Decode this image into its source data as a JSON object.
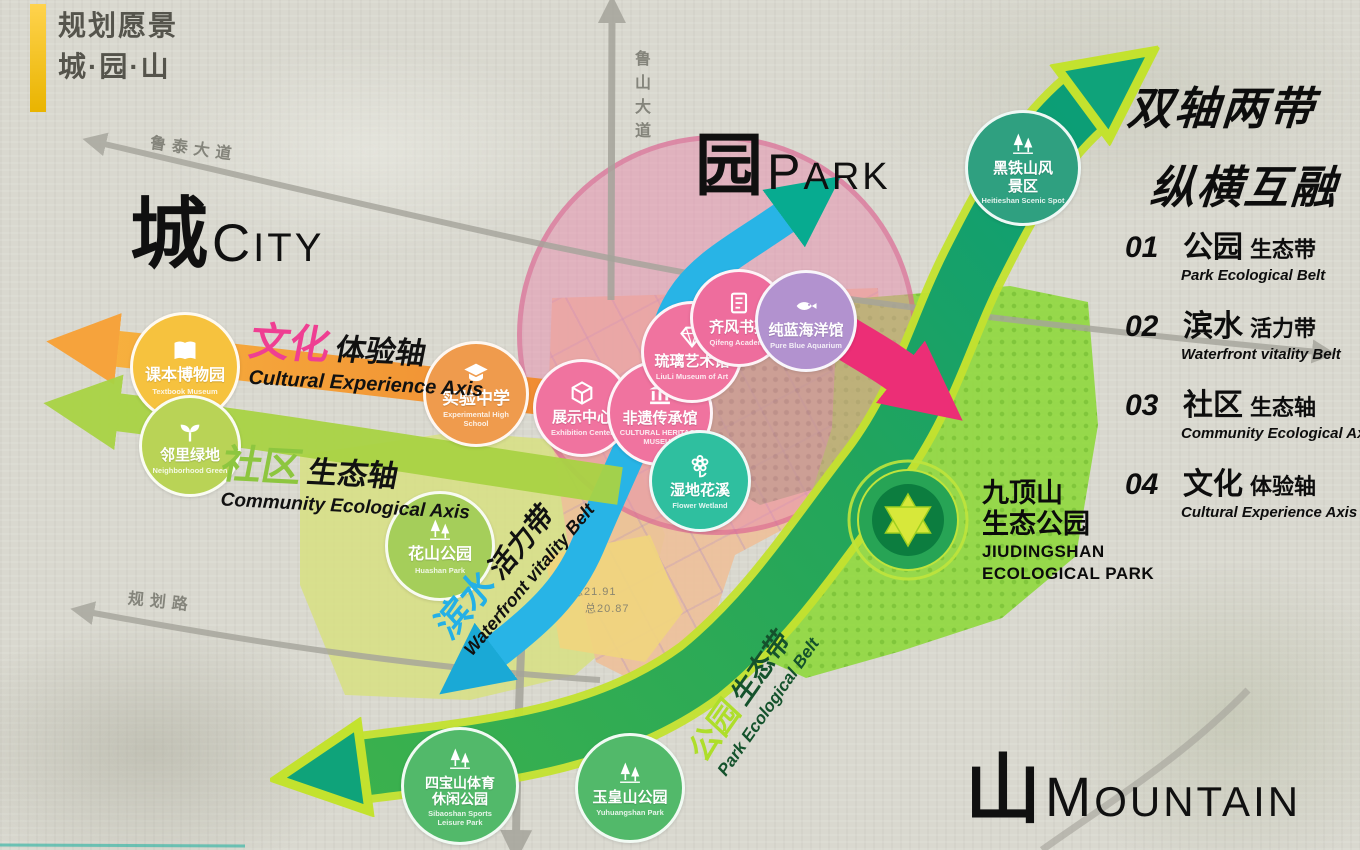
{
  "logo": {
    "line1": "规划愿景",
    "line2": "城·园·山"
  },
  "headline": {
    "line1": "双轴两带",
    "line2": "纵横互融"
  },
  "legend": [
    {
      "num": "01",
      "cn_main": "公园",
      "cn_sub": "生态带",
      "en": "Park Ecological Belt"
    },
    {
      "num": "02",
      "cn_main": "滨水",
      "cn_sub": "活力带",
      "en": "Waterfront vitality Belt"
    },
    {
      "num": "03",
      "cn_main": "社区",
      "cn_sub": "生态轴",
      "en": "Community Ecological Axis"
    },
    {
      "num": "04",
      "cn_main": "文化",
      "cn_sub": "体验轴",
      "en": "Cultural Experience Axis"
    }
  ],
  "zone_labels": {
    "city_cn": "城",
    "city_en": "CITY",
    "park_cn": "园",
    "park_en": "PARK",
    "mountain_cn": "山",
    "mountain_en": "MOUNTAIN"
  },
  "axis_labels": {
    "cultural": {
      "cn_main": "文化",
      "cn_sub": "体验轴",
      "en": "Cultural Experience Axis"
    },
    "community": {
      "cn_main": "社区",
      "cn_sub": "生态轴",
      "en": "Community Ecological Axis"
    },
    "waterfront": {
      "cn_main": "滨水",
      "cn_sub": "活力带",
      "en": "Waterfront vitality Belt"
    },
    "park_belt": {
      "cn_main": "公园",
      "cn_sub": "生态带",
      "en": "Park Ecological Belt"
    }
  },
  "roads": {
    "lutai": "鲁泰大道",
    "lushan": "鲁山大道",
    "guihua": "规划路"
  },
  "badges": [
    {
      "id": "textbook-museum",
      "cn": "课本博物园",
      "en": "Textbook Museum",
      "icon": "open-book-icon",
      "color": "#f6c23e"
    },
    {
      "id": "neighborhood-green",
      "cn": "邻里绿地",
      "en": "Neighborhood Green",
      "icon": "sprout-icon",
      "color": "#b9d356"
    },
    {
      "id": "experimental-school",
      "cn": "实验中学",
      "en": "Experimental High School",
      "icon": "graduation-cap-icon",
      "color": "#ef9b4d"
    },
    {
      "id": "exhibition-center",
      "cn": "展示中心",
      "en": "Exhibition Center",
      "icon": "cube-icon",
      "color": "#f0739f"
    },
    {
      "id": "heritage-museum",
      "cn": "非遗传承馆",
      "en": "CULTURAL HERITAGE MUSEUM",
      "icon": "museum-icon",
      "color": "#f0739f"
    },
    {
      "id": "liuli-art-museum",
      "cn": "琉璃艺术馆",
      "en": "LiuLi Museum of Art",
      "icon": "diamond-icon",
      "color": "#f0739f"
    },
    {
      "id": "qifeng-academy",
      "cn": "齐风书苑",
      "en": "Qifeng Academy",
      "icon": "book-icon",
      "color": "#ee6d9d"
    },
    {
      "id": "aquarium",
      "cn": "纯蓝海洋馆",
      "en": "Pure Blue Aquarium",
      "icon": "fish-icon",
      "color": "#b292cf"
    },
    {
      "id": "wetland",
      "cn": "湿地花溪",
      "en": "Flower Wetland",
      "icon": "flower-icon",
      "color": "#2fbf9f"
    },
    {
      "id": "huashan-park",
      "cn": "花山公园",
      "en": "Huashan Park",
      "icon": "trees-icon",
      "color": "#a5ce5a"
    },
    {
      "id": "sibaoshan-park",
      "cn": "四宝山体育休闲公园",
      "en": "Sibaoshan Sports Leisure Park",
      "icon": "trees-icon",
      "color": "#52b96a"
    },
    {
      "id": "yuhuangshan-park",
      "cn": "玉皇山公园",
      "en": "Yuhuangshan Park",
      "icon": "trees-icon",
      "color": "#52b96a"
    },
    {
      "id": "heitieshan",
      "cn": "黑铁山风景区",
      "en": "Heitieshan Scenic Spot",
      "icon": "trees-icon",
      "color": "#2fa080"
    }
  ],
  "jiudingshan": {
    "cn_line1": "九顶山",
    "cn_line2": "生态公园",
    "en_line1": "JIUDINGSHAN",
    "en_line2": "ECOLOGICAL PARK"
  },
  "map_annotations": {
    "a1": "总21.91",
    "a2": "总20.87"
  },
  "colors": {
    "park_belt_green": "#23a55b",
    "belt_edge_lime": "#c3e22e",
    "waterfront_blue": "#28b4e6",
    "cultural_orange": "#f0913c",
    "community_green": "#a9d344",
    "magenta_arrow": "#ec2e76",
    "pink_zone": "#e78cae",
    "road_gray": "#a5a49b"
  }
}
